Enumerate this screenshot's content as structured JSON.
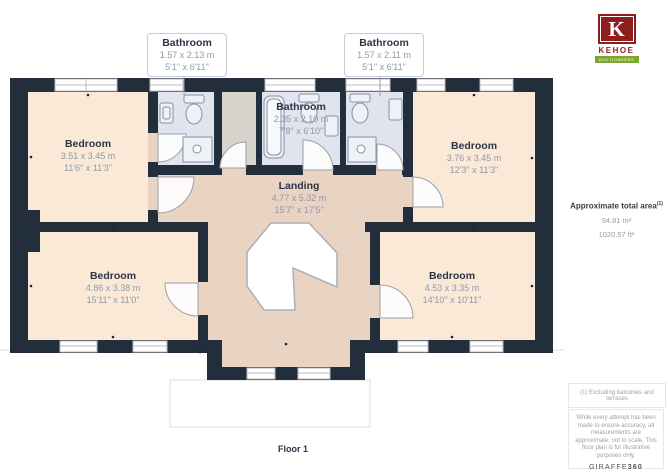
{
  "rooms": {
    "bathroom_top_left": {
      "name": "Bathroom",
      "metric": "1.57 x 2.13 m",
      "imperial": "5'1\" x 6'11\""
    },
    "bathroom_top_right": {
      "name": "Bathroom",
      "metric": "1.57 x 2.11 m",
      "imperial": "5'1\" x 6'11\""
    },
    "bathroom_center": {
      "name": "Bathroom",
      "metric": "2.35 x 2.10 m",
      "imperial": "7'8\" x 6'10\""
    },
    "bedroom_top_left": {
      "name": "Bedroom",
      "metric": "3.51 x 3.45 m",
      "imperial": "11'6\" x 11'3\""
    },
    "bedroom_top_right": {
      "name": "Bedroom",
      "metric": "3.76 x 3.45 m",
      "imperial": "12'3\" x 11'3\""
    },
    "landing": {
      "name": "Landing",
      "metric": "4.77 x 5.32 m",
      "imperial": "15'7\" x 17'5\""
    },
    "bedroom_bottom_left": {
      "name": "Bedroom",
      "metric": "4.86 x 3.38 m",
      "imperial": "15'11\" x 11'0\""
    },
    "bedroom_bottom_right": {
      "name": "Bedroom",
      "metric": "4.53 x 3.35 m",
      "imperial": "14'10\" x 10'11\""
    }
  },
  "sidebar": {
    "logo_letter": "K",
    "logo_name": "KEHOE",
    "logo_tagline": "AUCTIONEERS",
    "area_title": "Approximate total area",
    "area_superscript": "(1)",
    "area_m2": "94.81 m²",
    "area_ft2": "1020.57 ft²",
    "footnote": "(1) Excluding balconies and terraces",
    "disclaimer": "While every attempt has been made to ensure accuracy, all measurements are approximate, not to scale. This floor plan is for illustrative purposes only.",
    "brand": "GIRAFFE",
    "brand_suffix": "360"
  },
  "floor_label": "Floor 1",
  "colors": {
    "wall": "#232e3d",
    "bedroom": "#fbe9d8",
    "landing": "#e9d3c3",
    "bathroom": "#dfe4ef",
    "closet": "#d7d3cd",
    "logo_red": "#8e1e1e",
    "logo_green": "#7fa62c"
  }
}
